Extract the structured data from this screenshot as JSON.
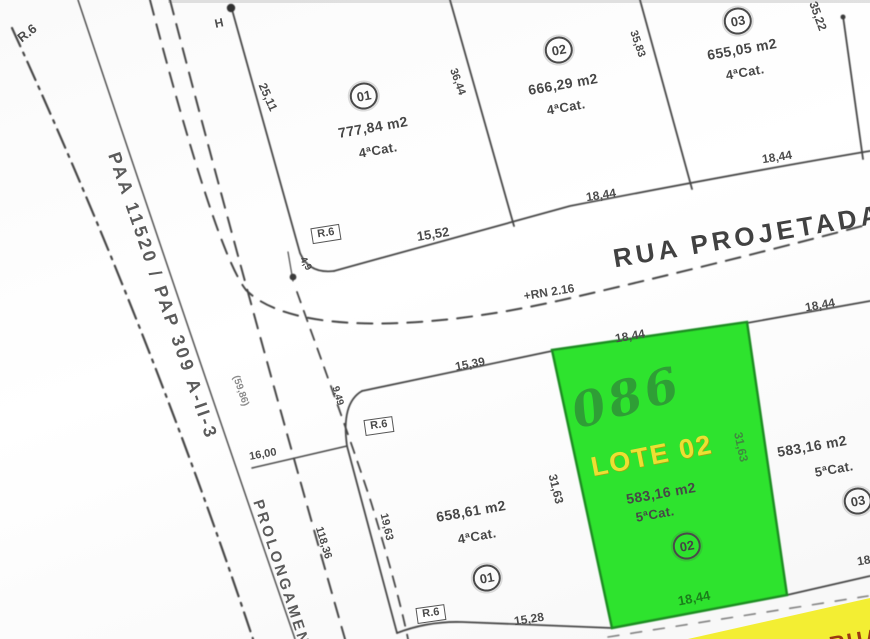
{
  "map": {
    "type": "cadastral-plat",
    "streets": {
      "main_street": "RUA PROJETADA",
      "benchmark": "+RN 2.16",
      "left_road": "PAA 11520 / PAP 309 A-II-3",
      "side_road_partial": "PROLONGAMEN",
      "bottom_street_partial": "RUA PROJ"
    },
    "lots": {
      "top_row": [
        {
          "number": "01",
          "area": "777,84 m2",
          "category": "4ªCat.",
          "frontage": "15,52",
          "sides": [
            "25,11",
            "36,44"
          ]
        },
        {
          "number": "02",
          "area": "666,29 m2",
          "category": "4ªCat.",
          "frontage": "18,44",
          "sides": [
            "36,44",
            "35,83"
          ]
        },
        {
          "number": "03",
          "area": "655,05 m2",
          "category": "4ªCat.",
          "frontage": "18,44",
          "sides": [
            "35,83",
            "35,22"
          ]
        }
      ],
      "bottom_row": [
        {
          "number": "01",
          "area": "658,61 m2",
          "category": "4ªCat.",
          "frontage_top": "15,39",
          "frontage_bottom": "15,28",
          "side": "19,63"
        },
        {
          "number": "02",
          "area": "583,16 m2",
          "category": "5ªCat.",
          "highlight_label": "LOTE 02",
          "handwritten": "086",
          "frontage_top": "18,44",
          "frontage_bottom": "18,44",
          "sides": [
            "31,63",
            "31,63"
          ]
        },
        {
          "number": "03",
          "area": "583,16 m2",
          "category": "5ªCat.",
          "frontage_top": "18,44",
          "frontage_bottom": "18,44"
        }
      ]
    },
    "other_dimensions": [
      "16,00",
      "118,36",
      "9,49",
      "4,9",
      "(59,86)"
    ],
    "corner_radius_labels": [
      "R.6",
      "R.6",
      "R.6",
      "R.6"
    ],
    "markers": [
      "H"
    ],
    "colors": {
      "highlight_lot_green": "#2ee32e",
      "highlight_lot_border": "#1d8c22",
      "lote_label_yellow": "#ecdf33",
      "handwritten_green": "#2f9e36",
      "street_highlight_yellow": "#f3ee33",
      "street_text_red": "#9c3a10",
      "linework_gray": "#474747"
    }
  },
  "labels": [
    {
      "name": "r6-curve-topleft",
      "text": "R.6",
      "x": 27,
      "y": 33,
      "rot": -38,
      "size": 13,
      "cls": "dim"
    },
    {
      "name": "h-marker",
      "text": "H",
      "x": 219,
      "y": 23,
      "rot": -12,
      "size": 12,
      "cls": "dim"
    },
    {
      "name": "dim-25-11",
      "text": "25,11",
      "x": 268,
      "y": 97,
      "rot": 66,
      "size": 12,
      "cls": "dim"
    },
    {
      "name": "road-label-paa",
      "text": "PAA 11520 / PAP 309 A-II-3",
      "x": 163,
      "y": 296,
      "rot": 71,
      "size": 18,
      "cls": "road"
    },
    {
      "name": "dim-59-86",
      "text": "(59,86)",
      "x": 240,
      "y": 391,
      "rot": 71,
      "size": 10,
      "cls": "dimlight"
    },
    {
      "name": "road-label-prolongamento",
      "text": "PROLONGAMEN",
      "x": 281,
      "y": 573,
      "rot": 72,
      "size": 15,
      "cls": "road"
    },
    {
      "name": "dim-16-00",
      "text": "16,00",
      "x": 263,
      "y": 455,
      "rot": -10,
      "size": 11,
      "cls": "dim"
    },
    {
      "name": "dim-118-36",
      "text": "118,36",
      "x": 323,
      "y": 543,
      "rot": 73,
      "size": 11,
      "cls": "dim"
    },
    {
      "name": "dim-19-63",
      "text": "19,63",
      "x": 386,
      "y": 527,
      "rot": 77,
      "size": 11,
      "cls": "dim"
    },
    {
      "name": "r6-box-street-corner",
      "text": "R.6",
      "x": 326,
      "y": 234,
      "rot": -9,
      "size": 11,
      "cls": "rbox"
    },
    {
      "name": "dim-4-9",
      "text": "4,9",
      "x": 305,
      "y": 264,
      "rot": 60,
      "size": 10,
      "cls": "dim"
    },
    {
      "name": "dim-15-52",
      "text": "15,52",
      "x": 433,
      "y": 234,
      "rot": -9,
      "size": 13,
      "cls": "dim"
    },
    {
      "name": "street-label-rua-projetada",
      "text": "RUA PROJETADA",
      "x": 748,
      "y": 236,
      "rot": -9.5,
      "size": 26,
      "cls": "street"
    },
    {
      "name": "rn-benchmark",
      "text": "+RN 2.16",
      "x": 549,
      "y": 292,
      "rot": -9,
      "size": 12,
      "cls": "dim"
    },
    {
      "name": "dim-18-44-lot02-front",
      "text": "18,44",
      "x": 601,
      "y": 195,
      "rot": -9,
      "size": 12,
      "cls": "dim"
    },
    {
      "name": "dim-18-44-lot03-front",
      "text": "18,44",
      "x": 777,
      "y": 157,
      "rot": -9,
      "size": 12,
      "cls": "dim"
    },
    {
      "name": "dim-35-22",
      "text": "35,22",
      "x": 818,
      "y": 16,
      "rot": 70,
      "size": 12,
      "cls": "dim"
    },
    {
      "name": "dim-15-39",
      "text": "15,39",
      "x": 470,
      "y": 364,
      "rot": -11,
      "size": 12,
      "cls": "dim"
    },
    {
      "name": "dim-18-44-green-top",
      "text": "18,44",
      "x": 630,
      "y": 336,
      "rot": -10,
      "size": 12,
      "cls": "dim"
    },
    {
      "name": "r6-box-lower-corner",
      "text": "R.6",
      "x": 379,
      "y": 426,
      "rot": -8,
      "size": 11,
      "cls": "rbox"
    },
    {
      "name": "dim-9-49",
      "text": "9,49",
      "x": 337,
      "y": 396,
      "rot": 74,
      "size": 10,
      "cls": "dim"
    },
    {
      "name": "lot-01-top-number",
      "text": "01",
      "x": 364,
      "y": 96,
      "rot": -10,
      "size": 13,
      "cls": "circled"
    },
    {
      "name": "lot-01-top-area",
      "text": "777,84 m2",
      "x": 373,
      "y": 127,
      "rot": -10,
      "size": 14,
      "cls": "lotinfo"
    },
    {
      "name": "lot-01-top-category",
      "text": "4ªCat.",
      "x": 378,
      "y": 150,
      "rot": -10,
      "size": 13,
      "cls": "lotinfo"
    },
    {
      "name": "dim-36-44",
      "text": "36,44",
      "x": 457,
      "y": 82,
      "rot": 70,
      "size": 11,
      "cls": "dim"
    },
    {
      "name": "lot-02-top-number",
      "text": "02",
      "x": 559,
      "y": 50,
      "rot": -10,
      "size": 13,
      "cls": "circled"
    },
    {
      "name": "lot-02-top-area",
      "text": "666,29 m2",
      "x": 563,
      "y": 84,
      "rot": -10,
      "size": 14,
      "cls": "lotinfo"
    },
    {
      "name": "lot-02-top-category",
      "text": "4ªCat.",
      "x": 566,
      "y": 107,
      "rot": -10,
      "size": 13,
      "cls": "lotinfo"
    },
    {
      "name": "dim-35-83",
      "text": "35,83",
      "x": 637,
      "y": 44,
      "rot": 71,
      "size": 11,
      "cls": "dim"
    },
    {
      "name": "lot-03-top-number",
      "text": "03",
      "x": 738,
      "y": 21,
      "rot": -10,
      "size": 13,
      "cls": "circled"
    },
    {
      "name": "lot-03-top-area",
      "text": "655,05 m2",
      "x": 742,
      "y": 49,
      "rot": -10,
      "size": 14,
      "cls": "lotinfo"
    },
    {
      "name": "lot-03-top-category",
      "text": "4ªCat.",
      "x": 745,
      "y": 72,
      "rot": -10,
      "size": 13,
      "cls": "lotinfo"
    },
    {
      "name": "handwritten-086",
      "text": "086",
      "x": 627,
      "y": 398,
      "rot": -16,
      "size": 48,
      "cls": "hand"
    },
    {
      "name": "lote-02-label",
      "text": "LOTE 02",
      "x": 652,
      "y": 456,
      "rot": -11,
      "size": 27,
      "cls": "lote"
    },
    {
      "name": "lote-02-area",
      "text": "583,16 m2",
      "x": 661,
      "y": 493,
      "rot": -10,
      "size": 14,
      "cls": "lotinfo"
    },
    {
      "name": "lote-02-category",
      "text": "5ªCat.",
      "x": 655,
      "y": 514,
      "rot": -10,
      "size": 13,
      "cls": "lotinfo"
    },
    {
      "name": "lote-02-number",
      "text": "02",
      "x": 687,
      "y": 546,
      "rot": -10,
      "size": 13,
      "cls": "circled"
    },
    {
      "name": "dim-18-44-green-bottom",
      "text": "18,44",
      "x": 694,
      "y": 598,
      "rot": -11,
      "size": 13,
      "cls": "dimgreen"
    },
    {
      "name": "dim-31-63-right",
      "text": "31,63",
      "x": 741,
      "y": 447,
      "rot": 78,
      "size": 12,
      "cls": "dimgreen2"
    },
    {
      "name": "dim-31-63-left",
      "text": "31,63",
      "x": 556,
      "y": 489,
      "rot": 76,
      "size": 12,
      "cls": "dim"
    },
    {
      "name": "lot-01-bottom-area",
      "text": "658,61 m2",
      "x": 471,
      "y": 511,
      "rot": -10,
      "size": 14,
      "cls": "lotinfo"
    },
    {
      "name": "lot-01-bottom-category",
      "text": "4ªCat.",
      "x": 477,
      "y": 536,
      "rot": -10,
      "size": 13,
      "cls": "lotinfo"
    },
    {
      "name": "lot-01-bottom-number",
      "text": "01",
      "x": 487,
      "y": 578,
      "rot": -10,
      "size": 13,
      "cls": "circled"
    },
    {
      "name": "r6-box-bottom",
      "text": "R.6",
      "x": 431,
      "y": 614,
      "rot": -8,
      "size": 11,
      "cls": "rbox"
    },
    {
      "name": "dim-15-28",
      "text": "15,28",
      "x": 529,
      "y": 619,
      "rot": -9,
      "size": 12,
      "cls": "dim"
    },
    {
      "name": "lot-03-bottom-area",
      "text": "583,16 m2",
      "x": 812,
      "y": 446,
      "rot": -10,
      "size": 14,
      "cls": "lotinfo"
    },
    {
      "name": "lot-03-bottom-category",
      "text": "5ªCat.",
      "x": 834,
      "y": 469,
      "rot": -10,
      "size": 13,
      "cls": "lotinfo"
    },
    {
      "name": "lot-03-bottom-number",
      "text": "03",
      "x": 858,
      "y": 501,
      "rot": -10,
      "size": 13,
      "cls": "circled"
    },
    {
      "name": "dim-18-44-lot03-bottom",
      "text": "18,44",
      "x": 872,
      "y": 559,
      "rot": -10,
      "size": 12,
      "cls": "dim"
    },
    {
      "name": "dim-18-44-lot03b-top",
      "text": "18,44",
      "x": 820,
      "y": 305,
      "rot": -10,
      "size": 12,
      "cls": "dim"
    },
    {
      "name": "street-label-bottom",
      "text": "RUA PROJ",
      "x": 893,
      "y": 634,
      "rot": -10,
      "size": 22,
      "cls": "streetred"
    }
  ]
}
